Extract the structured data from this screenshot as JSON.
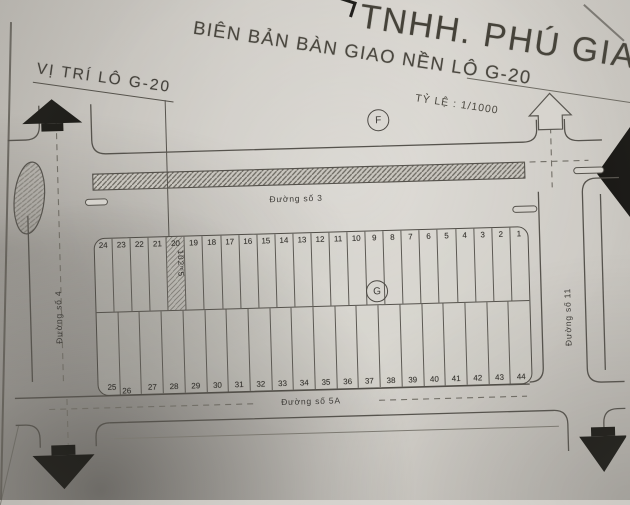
{
  "header": {
    "company": "TNHH. PHÚ GIA",
    "title": "BIÊN BẢN BÀN GIAO NỀN  LÔ G-20",
    "scale": "TỶ LỆ : 1/1000",
    "location": "VỊ TRÍ LÔ G-20"
  },
  "map": {
    "roads": {
      "top": "Đường số 3",
      "bottom": "Đường số 5A",
      "left": "Đường số 4",
      "right": "Đường số 11"
    },
    "markers": {
      "f": "F",
      "g": "G"
    },
    "highlight": {
      "plot": "20",
      "area_label": "102ᵐ5"
    },
    "plots_top": [
      "24",
      "23",
      "22",
      "21",
      "20",
      "19",
      "18",
      "17",
      "16",
      "15",
      "14",
      "13",
      "12",
      "11",
      "10",
      "9",
      "8",
      "7",
      "6",
      "5",
      "4",
      "3",
      "2",
      "1"
    ],
    "plots_bottom": [
      "25",
      "26",
      "27",
      "28",
      "29",
      "30",
      "31",
      "32",
      "33",
      "34",
      "35",
      "36",
      "37",
      "38",
      "39",
      "40",
      "41",
      "42",
      "43",
      "44"
    ]
  },
  "colors": {
    "paper": "#d0cdc7",
    "ink": "#4a4742",
    "arrow": "#1f1e1a",
    "hatch": "#6a675f"
  }
}
